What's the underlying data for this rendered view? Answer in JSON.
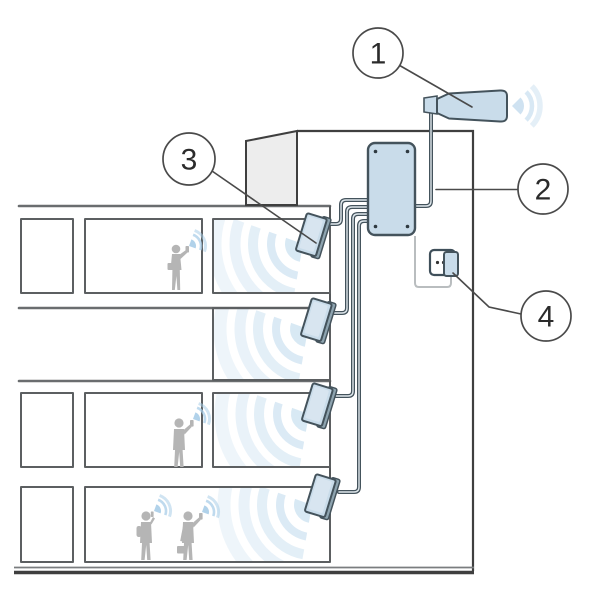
{
  "diagram": {
    "title": "building-signal-repeater-diagram",
    "callouts": [
      {
        "id": "callout-1",
        "label": "1"
      },
      {
        "id": "callout-2",
        "label": "2"
      },
      {
        "id": "callout-3",
        "label": "3"
      },
      {
        "id": "callout-4",
        "label": "4"
      }
    ],
    "colors": {
      "accent_fill": "#c9dcea",
      "accent_stroke": "#44535c",
      "panel_side": "#8ea4b0",
      "wave": "#c8dff0",
      "wave_strong": "#a9cde8",
      "line": "#4a4a4a",
      "room_line": "#5c5f61",
      "people": "#b5b5b5",
      "roof_fill": "#ededed",
      "ground": "#3f3f3f",
      "cord": "#b9bdbf",
      "outlet_fill": "#ffffff"
    }
  }
}
